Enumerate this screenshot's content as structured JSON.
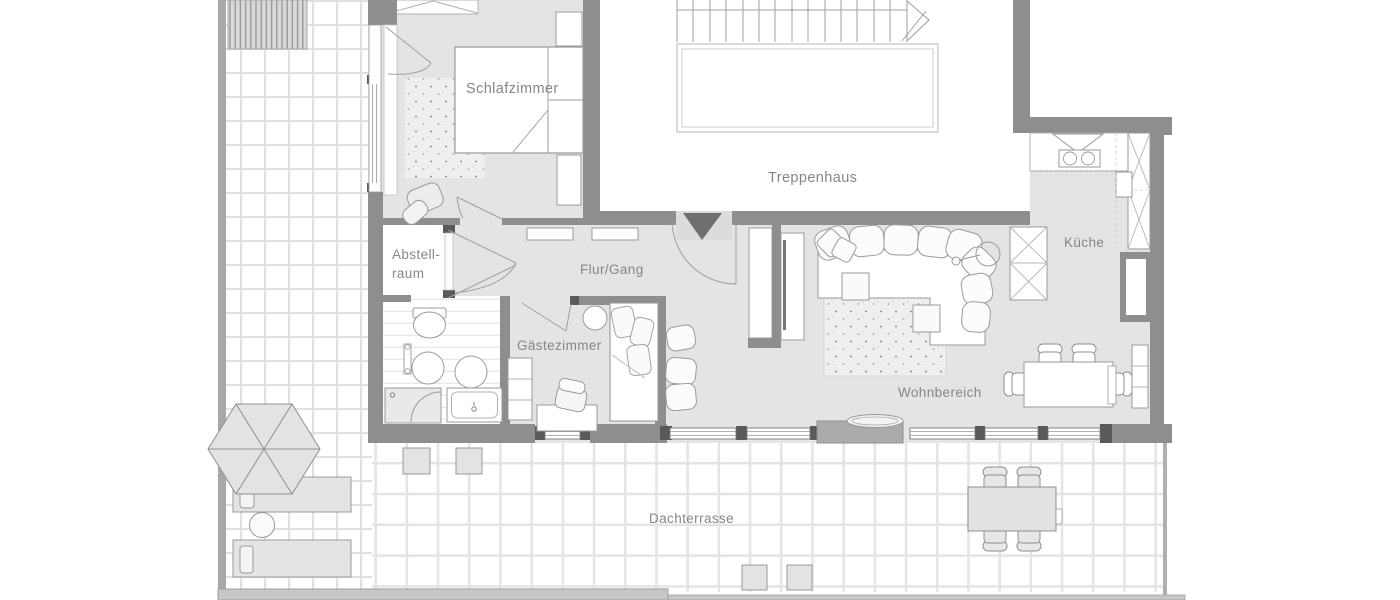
{
  "plan": {
    "rooms": {
      "schlafzimmer": {
        "label": "Schlafzimmer"
      },
      "treppenhaus": {
        "label": "Treppenhaus"
      },
      "abstellraum": {
        "label_line1": "Abstell-",
        "label_line2": "raum"
      },
      "flur_gang": {
        "label": "Flur/Gang"
      },
      "gaestezimmer": {
        "label": "Gästezimmer"
      },
      "kueche": {
        "label": "Küche"
      },
      "wohnbereich": {
        "label": "Wohnbereich"
      },
      "dachterrasse": {
        "label": "Dachterrasse"
      }
    },
    "colors": {
      "wall": "#8e8e8e",
      "wall_post": "#5a5a5a",
      "entrance_door_marker": "#6f6f6f",
      "interior_floor": "#e4e4e4",
      "room_white": "#ffffff",
      "furniture_outline": "#9a9a9a",
      "label_text": "#868686",
      "tile_grout": "#e1e1e1",
      "parapet": "#a8a8a8"
    }
  }
}
